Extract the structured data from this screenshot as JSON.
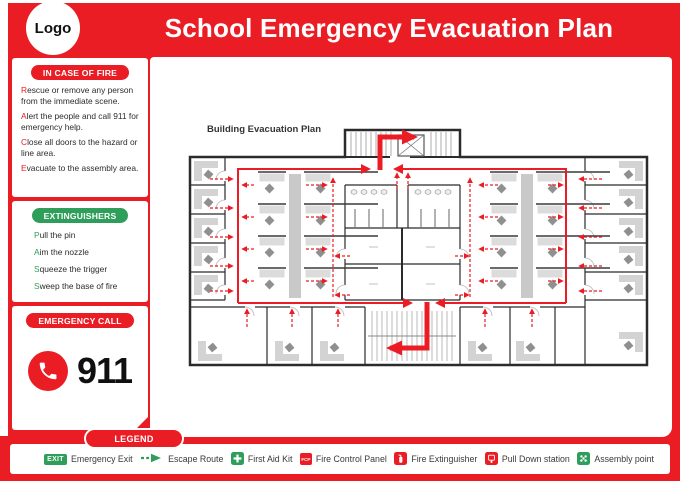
{
  "colors": {
    "brand_red": "#ea1c24",
    "route_red": "#ec1c24",
    "green": "#2e9e5a",
    "wall": "#2b2b2b"
  },
  "header": {
    "logo": "Logo",
    "title": "School Emergency Evacuation Plan"
  },
  "sidebar": {
    "fire": {
      "title": "IN CASE OF FIRE",
      "items": [
        {
          "lead": "R",
          "rest": "escue or remove any person from the immediate scene."
        },
        {
          "lead": "A",
          "rest": "lert the people and call 911 for emergency help."
        },
        {
          "lead": "C",
          "rest": "lose all doors to the hazard or line area."
        },
        {
          "lead": "E",
          "rest": "vacuate to the assembly area."
        }
      ]
    },
    "extinguishers": {
      "title": "EXTINGUISHERS",
      "items": [
        {
          "lead": "P",
          "rest": "ull the pin"
        },
        {
          "lead": "A",
          "rest": "im the nozzle"
        },
        {
          "lead": "S",
          "rest": "queeze the trigger"
        },
        {
          "lead": "S",
          "rest": "weep the base of fire"
        }
      ]
    },
    "emergency_call": {
      "title": "EMERGENCY CALL",
      "number": "911"
    }
  },
  "plan": {
    "title": "Building Evacuation Plan"
  },
  "legend": {
    "title": "LEGEND",
    "items": [
      {
        "icon": "exit-icon",
        "icon_text": "EXIT",
        "label": "Emergency Exit"
      },
      {
        "icon": "escape-route-icon",
        "label": "Escape Route"
      },
      {
        "icon": "first-aid-icon",
        "label": "First Aid Kit"
      },
      {
        "icon": "fcp-icon",
        "icon_text": "FCP",
        "label": "Fire Control Panel"
      },
      {
        "icon": "fire-extinguisher-icon",
        "label": "Fire Extinguisher"
      },
      {
        "icon": "pull-down-station-icon",
        "label": "Pull Down station"
      },
      {
        "icon": "assembly-point-icon",
        "label": "Assembly point"
      }
    ]
  }
}
